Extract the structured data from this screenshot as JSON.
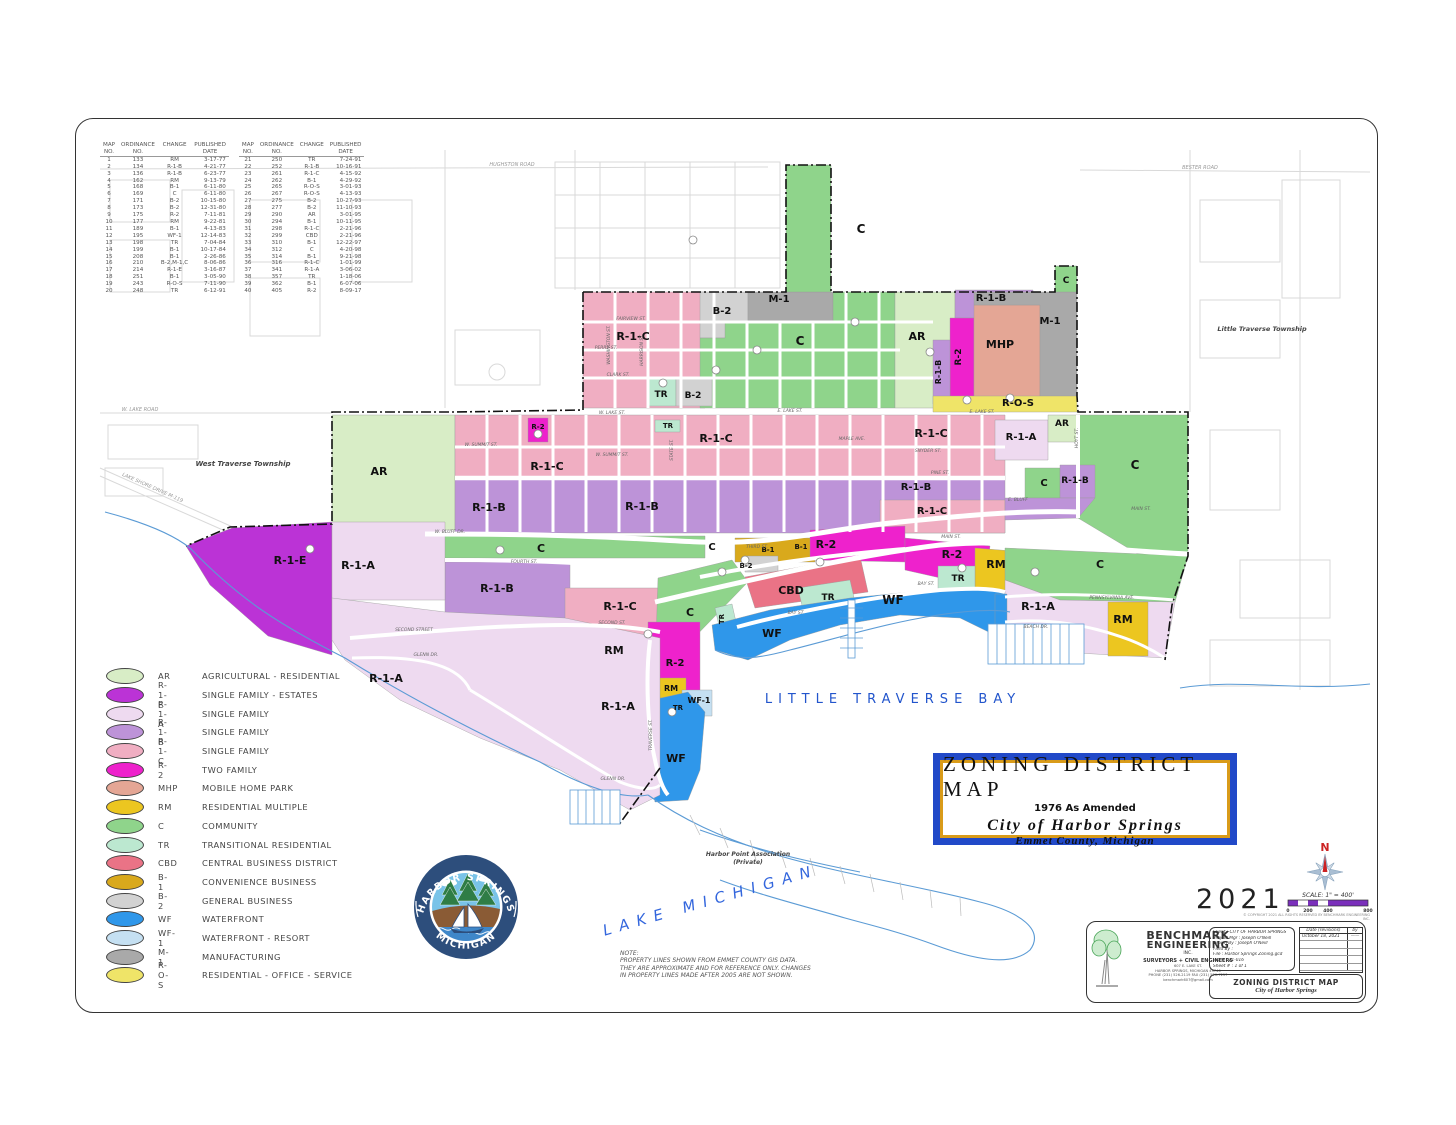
{
  "palette": {
    "AR": "#d8edc6",
    "R-1-E": "#bb33d6",
    "R-1-A": "#eedaf0",
    "R-1-B": "#bd93d8",
    "R-1-C": "#f0aec2",
    "R-2": "#ee22cc",
    "MHP": "#e4a695",
    "RM": "#ecc620",
    "C": "#8fd48b",
    "TR": "#bce8d0",
    "CBD": "#ea7386",
    "B-1": "#d9a91c",
    "B-2": "#d2d2d2",
    "WF": "#2f97ea",
    "WF-1": "#c5e0f2",
    "M-1": "#a9a9a9",
    "R-O-S": "#efe468",
    "water_line": "#5b9bd5",
    "bay_text": "#2255cc",
    "title_blue": "#2149c8",
    "title_gold": "#d99b19",
    "scale_purple": "#7a2fbb",
    "north_red": "#cc2222",
    "boundary": "#111111"
  },
  "ordinance": {
    "h1": [
      "MAP",
      "ORDINANCE",
      "CHANGE",
      "PUBLISHED"
    ],
    "h2": [
      "NO.",
      "NO.",
      "",
      "DATE"
    ],
    "left_rows": [
      [
        "1",
        "133",
        "RM",
        "3-17-77"
      ],
      [
        "2",
        "134",
        "R-1-B",
        "4-21-77"
      ],
      [
        "3",
        "136",
        "R-1-B",
        "6-23-77"
      ],
      [
        "4",
        "162",
        "RM",
        "9-13-79"
      ],
      [
        "5",
        "168",
        "B-1",
        "6-11-80"
      ],
      [
        "6",
        "169",
        "C",
        "6-11-80"
      ],
      [
        "7",
        "171",
        "B-2",
        "10-15-80"
      ],
      [
        "8",
        "173",
        "B-2",
        "12-31-80"
      ],
      [
        "9",
        "175",
        "R-2",
        "7-11-81"
      ],
      [
        "10",
        "177",
        "RM",
        "9-22-81"
      ],
      [
        "11",
        "189",
        "B-1",
        "4-13-83"
      ],
      [
        "12",
        "195",
        "WF-1",
        "12-14-83"
      ],
      [
        "13",
        "198",
        "TR",
        "7-04-84"
      ],
      [
        "14",
        "199",
        "B-1",
        "10-17-84"
      ],
      [
        "15",
        "208",
        "B-1",
        "2-26-86"
      ],
      [
        "16",
        "210",
        "B-2,M-1,C",
        "8-06-86"
      ],
      [
        "17",
        "214",
        "R-1-E",
        "3-16-87"
      ],
      [
        "18",
        "251",
        "B-1",
        "3-05-90"
      ],
      [
        "19",
        "243",
        "R-O-S",
        "7-11-90"
      ],
      [
        "20",
        "248",
        "TR",
        "6-12-91"
      ]
    ],
    "right_rows": [
      [
        "21",
        "250",
        "TR",
        "7-24-91"
      ],
      [
        "22",
        "252",
        "R-1-B",
        "10-16-91"
      ],
      [
        "23",
        "261",
        "R-1-C",
        "4-15-92"
      ],
      [
        "24",
        "262",
        "B-1",
        "4-29-92"
      ],
      [
        "25",
        "265",
        "R-O-S",
        "3-01-93"
      ],
      [
        "26",
        "267",
        "R-O-S",
        "4-13-93"
      ],
      [
        "27",
        "275",
        "B-2",
        "10-27-93"
      ],
      [
        "28",
        "277",
        "B-2",
        "11-10-93"
      ],
      [
        "29",
        "290",
        "AR",
        "3-01-95"
      ],
      [
        "30",
        "294",
        "B-1",
        "10-11-95"
      ],
      [
        "31",
        "298",
        "R-1-C",
        "2-21-96"
      ],
      [
        "32",
        "299",
        "CBD",
        "2-21-96"
      ],
      [
        "33",
        "310",
        "B-1",
        "12-22-97"
      ],
      [
        "34",
        "312",
        "C",
        "4-20-98"
      ],
      [
        "35",
        "314",
        "B-1",
        "9-21-98"
      ],
      [
        "36",
        "316",
        "R-1-C",
        "1-01-99"
      ],
      [
        "37",
        "341",
        "R-1-A",
        "3-06-02"
      ],
      [
        "38",
        "357",
        "TR",
        "1-18-06"
      ],
      [
        "39",
        "362",
        "B-1",
        "6-07-06"
      ],
      [
        "40",
        "405",
        "R-2",
        "8-09-17"
      ]
    ]
  },
  "legend": {
    "items": [
      {
        "code": "AR",
        "label": "AGRICULTURAL - RESIDENTIAL",
        "color": "#d8edc6"
      },
      {
        "code": "R-1-E",
        "label": "SINGLE FAMILY - ESTATES",
        "color": "#bb33d6"
      },
      {
        "code": "R-1-A",
        "label": "SINGLE FAMILY",
        "color": "#eedaf0"
      },
      {
        "code": "R-1-B",
        "label": "SINGLE FAMILY",
        "color": "#bd93d8"
      },
      {
        "code": "R-1-C",
        "label": "SINGLE FAMILY",
        "color": "#f0aec2"
      },
      {
        "code": "R-2",
        "label": "TWO FAMILY",
        "color": "#ee22cc"
      },
      {
        "code": "MHP",
        "label": "MOBILE HOME PARK",
        "color": "#e4a695"
      },
      {
        "code": "RM",
        "label": "RESIDENTIAL MULTIPLE",
        "color": "#ecc620"
      },
      {
        "code": "C",
        "label": "COMMUNITY",
        "color": "#8fd48b"
      },
      {
        "code": "TR",
        "label": "TRANSITIONAL RESIDENTIAL",
        "color": "#bce8d0"
      },
      {
        "code": "CBD",
        "label": "CENTRAL BUSINESS DISTRICT",
        "color": "#ea7386"
      },
      {
        "code": "B-1",
        "label": "CONVENIENCE BUSINESS",
        "color": "#d9a91c"
      },
      {
        "code": "B-2",
        "label": "GENERAL BUSINESS",
        "color": "#d2d2d2"
      },
      {
        "code": "WF",
        "label": "WATERFRONT",
        "color": "#2f97ea"
      },
      {
        "code": "WF-1",
        "label": "WATERFRONT - RESORT",
        "color": "#c5e0f2"
      },
      {
        "code": "M-1",
        "label": "MANUFACTURING",
        "color": "#a9a9a9"
      },
      {
        "code": "R-O-S",
        "label": "RESIDENTIAL - OFFICE - SERVICE",
        "color": "#efe468"
      }
    ]
  },
  "map": {
    "zones": [
      "B-2",
      "M-1",
      "R-1-C",
      "C",
      "C",
      "AR",
      "R-1-B",
      "R-2",
      "R-1-B",
      "MHP",
      "M-1",
      "R-O-S",
      "TR",
      "B-2",
      "C",
      "R-2",
      "TR",
      "AR",
      "R-1-C",
      "R-1-C",
      "R-1-C",
      "R-1-A",
      "AR",
      "C",
      "R-1-B",
      "R-1-B",
      "R-1-B",
      "C",
      "R-1-B",
      "R-1-C",
      "C",
      "C",
      "B-1",
      "B-1",
      "B-2",
      "R-2",
      "R-2",
      "RM",
      "TR",
      "CBD",
      "TR",
      "WF",
      "WF",
      "C",
      "TR",
      "R-1-E",
      "R-1-A",
      "R-1-B",
      "R-1-C",
      "RM",
      "R-2",
      "RM",
      "WF-1",
      "TR",
      "R-1-A",
      "R-1-A",
      "WF",
      "R-1-A",
      "RM",
      "C"
    ],
    "streets": [
      "W. LAKE ST.",
      "E. LAKE ST.",
      "E. LAKE ST.",
      "FAIRVIEW ST.",
      "PERRY ST.",
      "CLARK ST.",
      "W. SUMMIT ST.",
      "W. SUMMIT ST.",
      "SNYDER ST.",
      "MAPLE AVE.",
      "PINE ST.",
      "W. BLUFF DR.",
      "E. BLUFF",
      "FOURTH ST.",
      "THIRD ST.",
      "SECOND ST.",
      "SECOND STREET",
      "GLENN DR.",
      "GLENN DR.",
      "MAIN ST.",
      "BAY ST.",
      "BAY ST.",
      "PENNSYLVANIA AVE.",
      "BEACH DR.",
      "MAIN ST.",
      "STATE ST.",
      "TRAVERSE ST.",
      "HOYT ST.",
      "WASHINGTON ST.",
      "HARRISON ST."
    ],
    "places": {
      "west_township": "West Traverse Township",
      "little_township": "Little Traverse Township",
      "bay": "LITTLE  TRAVERSE  BAY",
      "lake": "LAKE  MICHIGAN",
      "harbor_point_1": "Harbor Point Association",
      "harbor_point_2": "(Private)",
      "hughston": "HUGHSTON  ROAD",
      "bester": "BESTER  ROAD",
      "w_lake_road": "W.  LAKE  ROAD",
      "m119": "LAKE  SHORE  DRIVE   M-119"
    }
  },
  "title_block": {
    "line1": "ZONING  DISTRICT  MAP",
    "line2": "1976  As  Amended",
    "line3": "City  of  Harbor  Springs",
    "line4": "Emmet  County,  Michigan"
  },
  "year": "2021",
  "compass": {
    "n": "N"
  },
  "scale": {
    "label": "SCALE:  1\" = 400'",
    "ticks": [
      "0",
      "200",
      "400",
      "800"
    ],
    "copyright": "© COPYRIGHT 2021   ALL RIGHTS RESERVED BY BENCHMARK ENGINEERING INC."
  },
  "note": {
    "title": "NOTE:",
    "line1": "PROPERTY LINES SHOWN FROM EMMET COUNTY GIS DATA.",
    "line2": "THEY ARE APPROXIMATE AND FOR REFERENCE ONLY.   CHANGES",
    "line3": "IN PROPERTY LINES MADE AFTER 2005 ARE NOT SHOWN."
  },
  "logo": {
    "top": "HARBOR  SPRINGS",
    "bottom": "MICHIGAN"
  },
  "eng": {
    "name1": "BENCHMARK",
    "name2": "ENGINEERING",
    "name3": "INC.",
    "tagline": "SURVEYORS + CIVIL ENGINEERS",
    "addr1": "607 E. LAKE ST.",
    "addr2": "HARBOR SPRINGS, MICHIGAN  49740",
    "addr3": "PHONE (231) 526-2119   FAX (231) 526-7257",
    "addr4": "benchmark607@gmail.com",
    "client": "Client : CITY OF HARBOR SPRINGS",
    "mgr": "Project Mgr : Joseph O'Neill",
    "drawn": "Drawn By : Joseph O'Neill",
    "field": "Field By :",
    "file": "File : Harbor Springs Zoning.gcd",
    "job": "Job # : 21-016",
    "sheetno": "Sheet # : 1  of  1",
    "rev_date": "Date  (revisions)",
    "rev_by": "by",
    "rev_entry_date": "October 18, 2021",
    "rev_entry_by": "——",
    "title1": "ZONING  DISTRICT  MAP",
    "title2": "City  of  Harbor  Springs"
  }
}
